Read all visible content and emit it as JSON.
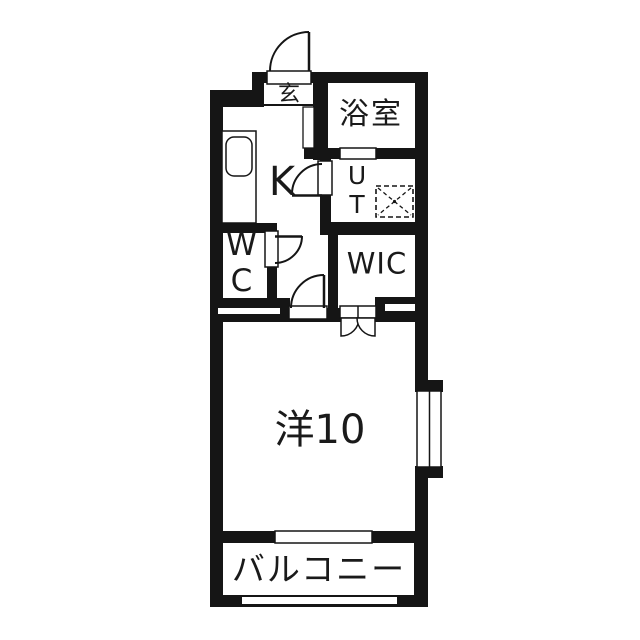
{
  "floorplan": {
    "rooms": {
      "genkan": {
        "label": "玄"
      },
      "bathroom": {
        "label": "浴室"
      },
      "kitchen": {
        "label": "K"
      },
      "utility": {
        "label": "UT"
      },
      "toilet": {
        "label": "WC"
      },
      "closet": {
        "label": "WIC"
      },
      "main_room": {
        "label": "洋10"
      },
      "balcony": {
        "label": "バルコニー"
      }
    },
    "colors": {
      "wall": "#151515",
      "background": "#ffffff"
    }
  }
}
